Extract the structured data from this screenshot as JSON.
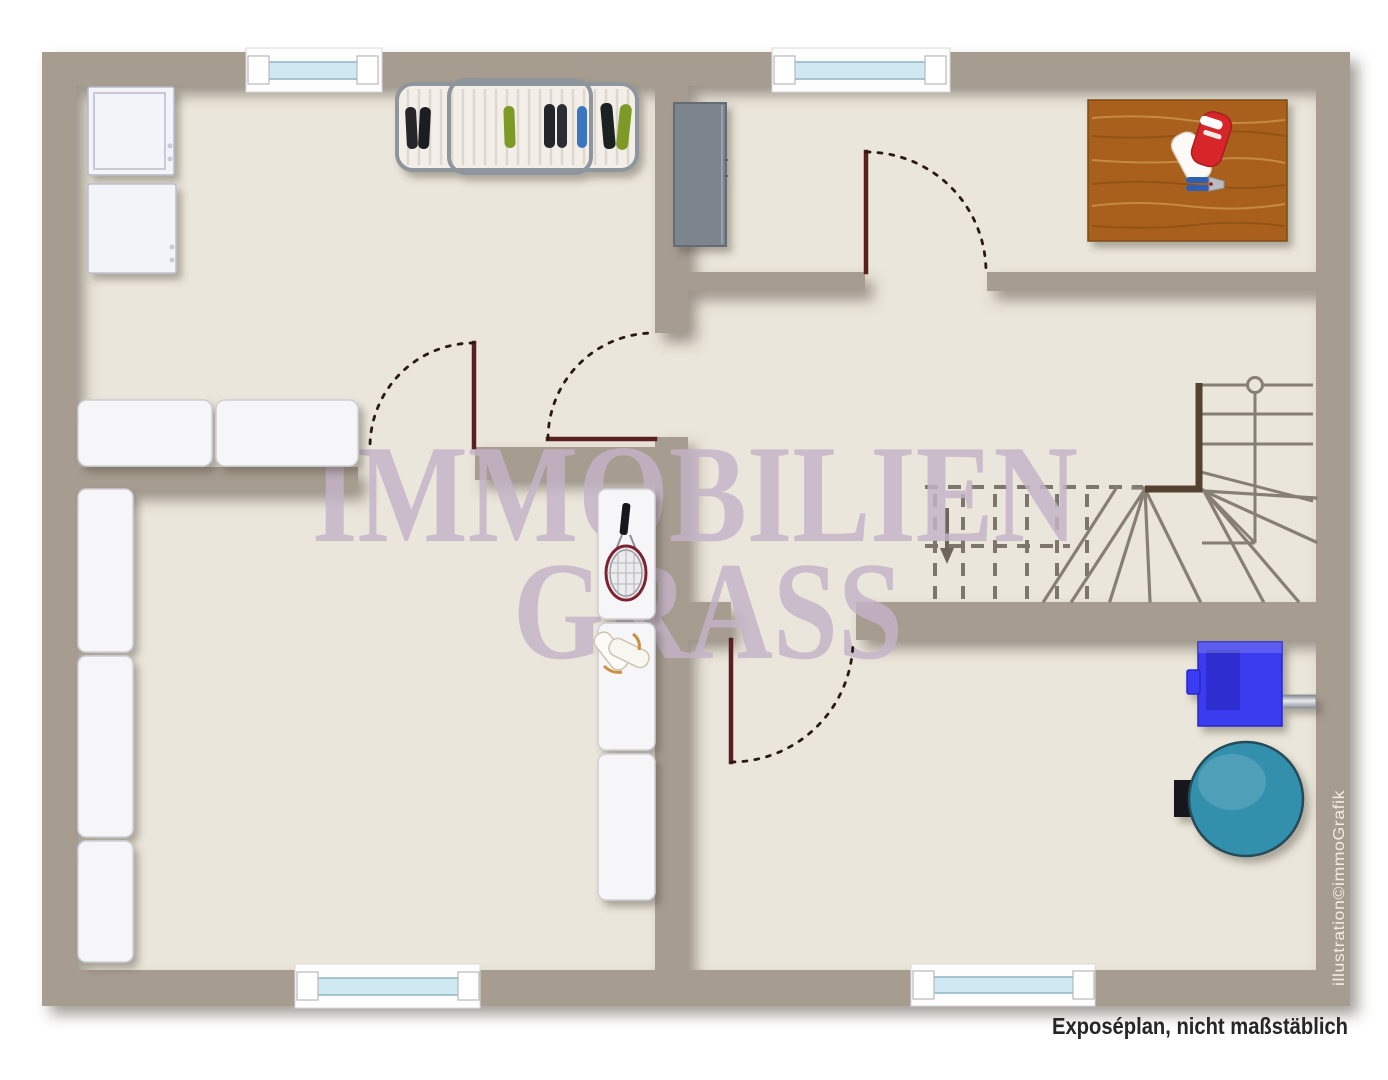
{
  "watermark": {
    "line1": "IMMOBILIEN",
    "line2": "GRASS",
    "color": "#c5b4c9"
  },
  "caption": {
    "text": "Exposéplan, nicht maßstäblich",
    "color": "#262626"
  },
  "credit": {
    "text": "illustration©immoGrafik",
    "color": "#f2ede3"
  },
  "palette": {
    "page_background": "#ffffff",
    "floor": "#ebe6db",
    "wall": "#a79c90",
    "door_leaf": "#5a2020",
    "door_swing": "#2b1a12",
    "stair_lines": "#877f75",
    "stair_wall": "#54412f",
    "window_glass": "#cfe9f2",
    "window_frame": "#fdfdfd",
    "furnace": "#3a3af0",
    "tank": "#3390ad",
    "workbench": "#a9611b",
    "cabinet": "#7c848d",
    "appliance": "#f3f4fa"
  },
  "icons": {
    "washer": "washing-machine-icon",
    "dryer": "dryer-icon",
    "shoe_rack": "shoe-rack-icon",
    "cabinet": "storage-cabinet-icon",
    "workbench": "workbench-icon",
    "gloves": "work-gloves-icon",
    "pliers": "pliers-icon",
    "storage_boxes": "storage-boxes-icon",
    "shelves": "shelf-column-icon",
    "tennis_racket": "tennis-racket-icon",
    "sneakers": "sneakers-icon",
    "stairs": "staircase-icon",
    "furnace": "furnace-icon",
    "oil_tank": "oil-tank-icon",
    "window": "window-icon",
    "door": "door-swing-icon"
  }
}
